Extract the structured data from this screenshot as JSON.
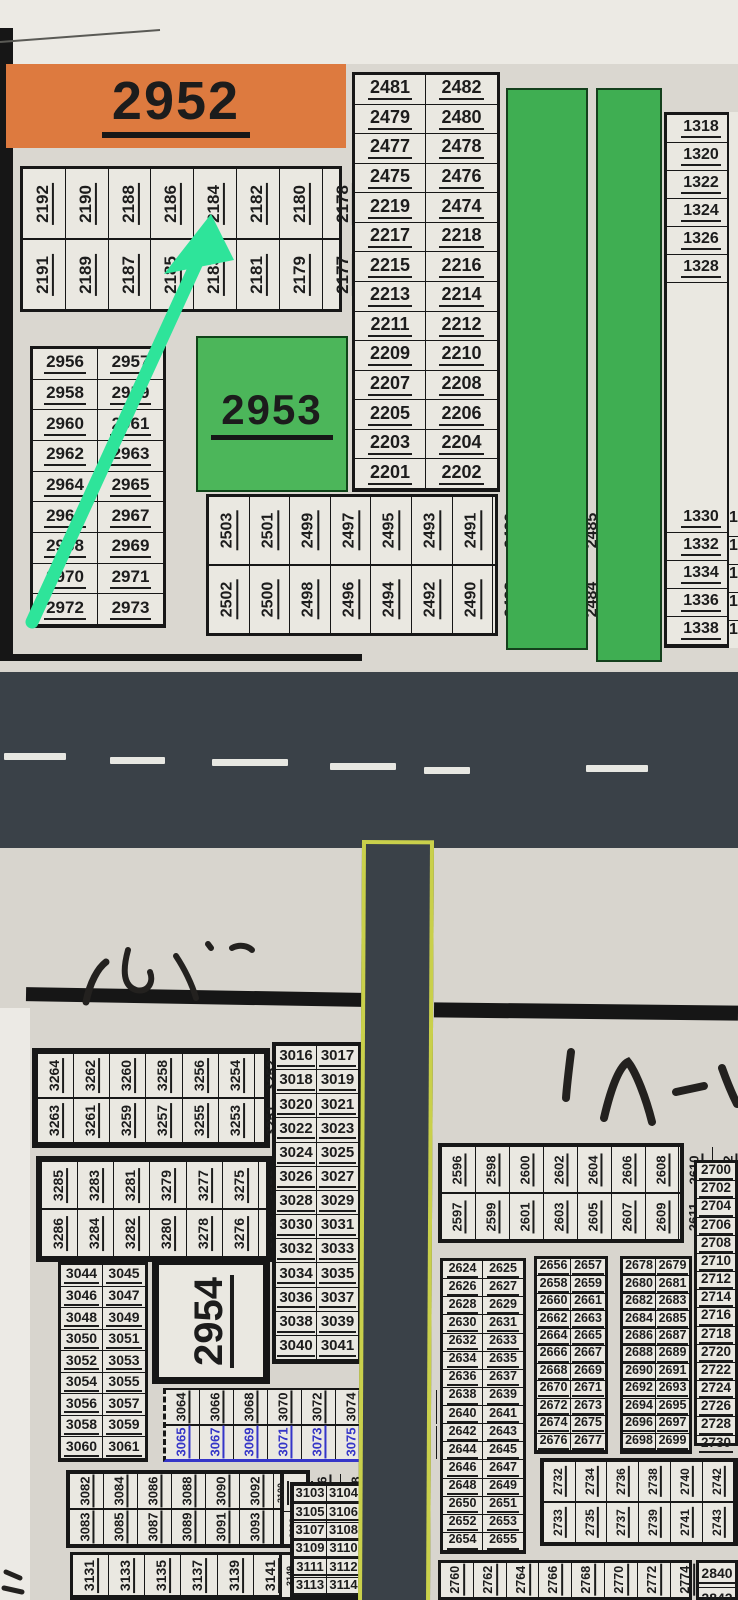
{
  "colors": {
    "banner_orange": "#dd7a3f",
    "block_green": "#4cb65a",
    "strip_green": "#3fae52",
    "arrow_green": "#2ee49a",
    "road_gray": "#3a4148",
    "lane_white": "#e7e7e2",
    "curb_yellow": "#c9d04b",
    "ink_blue": "#3535c8",
    "ink_black": "#1c1c1c",
    "paper": "#d8d5ce"
  },
  "annotations": {
    "arrow_points_to": "2180"
  },
  "top": {
    "banner": "2952",
    "green_block": "2953",
    "strip_2170s": {
      "row_top": [
        "2192",
        "2190",
        "2188",
        "2186",
        "2184",
        "2182",
        "2180",
        "2178",
        "2176",
        "2174",
        "2172"
      ],
      "row_bottom": [
        "2191",
        "2189",
        "2187",
        "2185",
        "2183",
        "2181",
        "2179",
        "2177",
        "2175",
        "2173",
        "2171"
      ]
    },
    "table_2950s": {
      "pairs": [
        [
          "2956",
          "2957"
        ],
        [
          "2958",
          "2959"
        ],
        [
          "2960",
          "2961"
        ],
        [
          "2962",
          "2963"
        ],
        [
          "2964",
          "2965"
        ],
        [
          "2966",
          "2967"
        ],
        [
          "2968",
          "2969"
        ],
        [
          "2970",
          "2971"
        ],
        [
          "2972",
          "2973"
        ]
      ]
    },
    "strip_2480s_2500s": {
      "row_top": [
        "2503",
        "2501",
        "2499",
        "2497",
        "2495",
        "2493",
        "2491",
        "2489",
        "2487",
        "2485",
        "2483"
      ],
      "row_bottom": [
        "2502",
        "2500",
        "2498",
        "2496",
        "2494",
        "2492",
        "2490",
        "2488",
        "2486",
        "2484",
        "2482"
      ]
    },
    "table_2200s_2470s": {
      "pairs": [
        [
          "2481",
          "2482"
        ],
        [
          "2479",
          "2480"
        ],
        [
          "2477",
          "2478"
        ],
        [
          "2475",
          "2476"
        ],
        [
          "2219",
          "2474"
        ],
        [
          "2217",
          "2218"
        ],
        [
          "2215",
          "2216"
        ],
        [
          "2213",
          "2214"
        ],
        [
          "2211",
          "2212"
        ],
        [
          "2209",
          "2210"
        ],
        [
          "2207",
          "2208"
        ],
        [
          "2205",
          "2206"
        ],
        [
          "2203",
          "2204"
        ],
        [
          "2201",
          "2202"
        ]
      ]
    },
    "col_right_top": [
      "1318",
      "1320",
      "1322",
      "1324",
      "1326",
      "1328"
    ],
    "col_right_bottom": [
      "1330",
      "1332",
      "1334",
      "1336",
      "1338"
    ],
    "col_right_partial": [
      "13",
      "13",
      "13",
      "13",
      "13"
    ]
  },
  "bottom": {
    "strip_3245_3264": {
      "row_top": [
        "3264",
        "3262",
        "3260",
        "3258",
        "3256",
        "3254",
        "3252",
        "3250",
        "3248",
        "3246"
      ],
      "row_bottom": [
        "3263",
        "3261",
        "3259",
        "3257",
        "3255",
        "3253",
        "3251",
        "3249",
        "3247",
        "3245"
      ]
    },
    "strip_3265_3286": {
      "row_top": [
        "3285",
        "3283",
        "3281",
        "3279",
        "3277",
        "3275",
        "3273",
        "3271",
        "3269",
        "3267",
        "3265"
      ],
      "row_bottom": [
        "3286",
        "3284",
        "3282",
        "3280",
        "3278",
        "3276",
        "3274",
        "3272",
        "3270",
        "3268",
        "3266"
      ]
    },
    "table_3044": {
      "pairs": [
        [
          "3044",
          "3045"
        ],
        [
          "3046",
          "3047"
        ],
        [
          "3048",
          "3049"
        ],
        [
          "3050",
          "3051"
        ],
        [
          "3052",
          "3053"
        ],
        [
          "3054",
          "3055"
        ],
        [
          "3056",
          "3057"
        ],
        [
          "3058",
          "3059"
        ],
        [
          "3060",
          "3061"
        ]
      ]
    },
    "block_2954": "2954",
    "table_3016": {
      "pairs": [
        [
          "3016",
          "3017"
        ],
        [
          "3018",
          "3019"
        ],
        [
          "3020",
          "3021"
        ],
        [
          "3022",
          "3023"
        ],
        [
          "3024",
          "3025"
        ],
        [
          "3026",
          "3027"
        ],
        [
          "3028",
          "3029"
        ],
        [
          "3030",
          "3031"
        ],
        [
          "3032",
          "3033"
        ],
        [
          "3034",
          "3035"
        ],
        [
          "3036",
          "3037"
        ],
        [
          "3038",
          "3039"
        ],
        [
          "3040",
          "3041"
        ]
      ]
    },
    "strip_3064": {
      "row_top": [
        "3064",
        "3066",
        "3068",
        "3070",
        "3072",
        "3074",
        "3076",
        "3078",
        "3080"
      ],
      "row_bottom_blue": [
        "3065",
        "3067",
        "3069",
        "3071",
        "3073",
        "3075",
        "3077",
        "3079",
        "3081"
      ]
    },
    "strip_3082": {
      "row_top": [
        "3082",
        "3084",
        "3086",
        "3088",
        "3090",
        "3092",
        "3094",
        "3096",
        "3098"
      ],
      "row_bottom": [
        "3083",
        "3085",
        "3087",
        "3089",
        "3091",
        "3093",
        "3095",
        "3097",
        "3099"
      ],
      "small_a": "3100",
      "small_b": "3101",
      "small_c": "3102"
    },
    "strip_3131": {
      "row": [
        "3131",
        "3133",
        "3135",
        "3137",
        "3139",
        "3141",
        "3143",
        "3145",
        "3147"
      ],
      "small": "3149"
    },
    "table_3103": {
      "pairs": [
        [
          "3103",
          "3104"
        ],
        [
          "3105",
          "3106"
        ],
        [
          "3107",
          "3108"
        ],
        [
          "3109",
          "3110"
        ],
        [
          "3111",
          "3112"
        ],
        [
          "3113",
          "3114"
        ]
      ]
    },
    "strip_2596": {
      "row_top": [
        "2596",
        "2598",
        "2600",
        "2602",
        "2604",
        "2606",
        "2608",
        "2610",
        "2612",
        "2614",
        "2616",
        "2618",
        "2620",
        "2622"
      ],
      "row_bottom": [
        "2597",
        "2599",
        "2601",
        "2603",
        "2605",
        "2607",
        "2609",
        "2611",
        "2613",
        "2615",
        "2617",
        "2619",
        "2621",
        "2623"
      ]
    },
    "table_2624": {
      "pairs": [
        [
          "2624",
          "2625"
        ],
        [
          "2626",
          "2627"
        ],
        [
          "2628",
          "2629"
        ],
        [
          "2630",
          "2631"
        ],
        [
          "2632",
          "2633"
        ],
        [
          "2634",
          "2635"
        ],
        [
          "2636",
          "2637"
        ],
        [
          "2638",
          "2639"
        ],
        [
          "2640",
          "2641"
        ],
        [
          "2642",
          "2643"
        ],
        [
          "2644",
          "2645"
        ],
        [
          "2646",
          "2647"
        ],
        [
          "2648",
          "2649"
        ],
        [
          "2650",
          "2651"
        ],
        [
          "2652",
          "2653"
        ],
        [
          "2654",
          "2655"
        ]
      ]
    },
    "table_2656": {
      "pairs": [
        [
          "2656",
          "2657"
        ],
        [
          "2658",
          "2659"
        ],
        [
          "2660",
          "2661"
        ],
        [
          "2662",
          "2663"
        ],
        [
          "2664",
          "2665"
        ],
        [
          "2666",
          "2667"
        ],
        [
          "2668",
          "2669"
        ],
        [
          "2670",
          "2671"
        ],
        [
          "2672",
          "2673"
        ],
        [
          "2674",
          "2675"
        ],
        [
          "2676",
          "2677"
        ]
      ]
    },
    "table_2678": {
      "pairs": [
        [
          "2678",
          "2679"
        ],
        [
          "2680",
          "2681"
        ],
        [
          "2682",
          "2683"
        ],
        [
          "2684",
          "2685"
        ],
        [
          "2686",
          "2687"
        ],
        [
          "2688",
          "2689"
        ],
        [
          "2690",
          "2691"
        ],
        [
          "2692",
          "2693"
        ],
        [
          "2694",
          "2695"
        ],
        [
          "2696",
          "2697"
        ],
        [
          "2698",
          "2699"
        ]
      ]
    },
    "col_2700": [
      "2700",
      "2702",
      "2704",
      "2706",
      "2708",
      "2710",
      "2712",
      "2714",
      "2716",
      "2718",
      "2720",
      "2722",
      "2724",
      "2726",
      "2728",
      "2730"
    ],
    "strip_2732": {
      "row_top": [
        "2732",
        "2734",
        "2736",
        "2738",
        "2740",
        "2742",
        "2744",
        "2746",
        "2748",
        "2750",
        "2752",
        "2754"
      ],
      "row_bottom": [
        "2733",
        "2735",
        "2737",
        "2739",
        "2741",
        "2743",
        "2745",
        "2747",
        "2749",
        "2751",
        "2753",
        "2755"
      ]
    },
    "strip_2760": {
      "row": [
        "2760",
        "2762",
        "2764",
        "2766",
        "2768",
        "2770",
        "2772",
        "2774",
        "2776",
        "2778",
        "2780",
        "2782",
        "2784",
        "2786"
      ]
    },
    "box_2840": [
      "2840",
      "2842"
    ]
  }
}
